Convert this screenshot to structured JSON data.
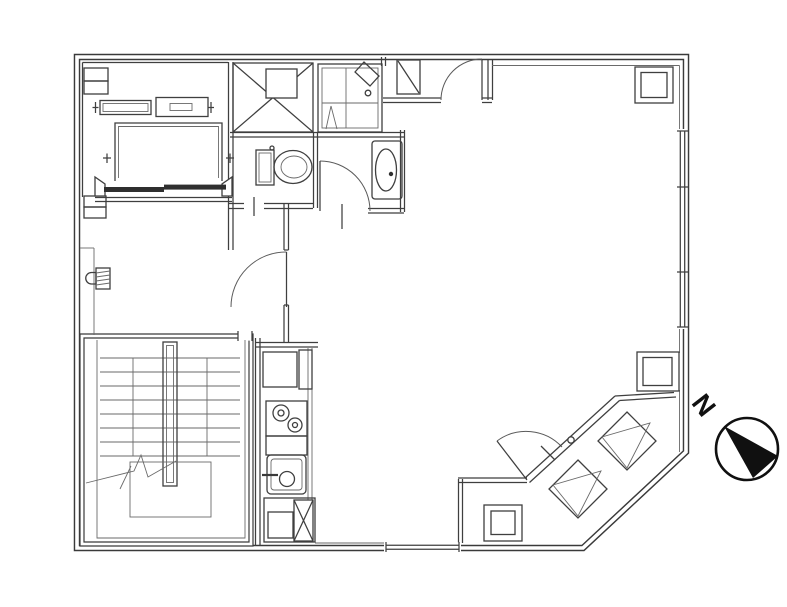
{
  "page": {
    "type": "architectural-floor-plan",
    "background": "#ffffff"
  },
  "colors": {
    "line": "#3a3a3a",
    "thin_line": "#6a6a6a",
    "door_arc": "#5a5a5a",
    "elevator_door": "#2f2f2f",
    "compass": "#101010",
    "background": "#ffffff"
  },
  "compass": {
    "label": "N",
    "direction": "upper-left"
  },
  "rooms": [
    {
      "name": "elevator-shaft"
    },
    {
      "name": "elevator-hall"
    },
    {
      "name": "stairwell"
    },
    {
      "name": "pipe-shaft-x"
    },
    {
      "name": "shower-room"
    },
    {
      "name": "toilet-room"
    },
    {
      "name": "washroom"
    },
    {
      "name": "entry-vestibule"
    },
    {
      "name": "kitchen"
    },
    {
      "name": "main-room"
    },
    {
      "name": "balcony"
    }
  ],
  "fixtures": [
    {
      "name": "elevator-car"
    },
    {
      "name": "elevator-doors"
    },
    {
      "name": "elevator-machine"
    },
    {
      "name": "counterweight-guides"
    },
    {
      "name": "u-shaped-stair-with-break-line"
    },
    {
      "name": "stair-center-rail"
    },
    {
      "name": "toilet"
    },
    {
      "name": "vanity-basin"
    },
    {
      "name": "shower-pan"
    },
    {
      "name": "shower-pivot-door"
    },
    {
      "name": "refrigerator-space"
    },
    {
      "name": "two-burner-stove"
    },
    {
      "name": "kitchen-sink"
    },
    {
      "name": "pipe-shaft-x-kitchen"
    },
    {
      "name": "meter-box"
    },
    {
      "name": "structural-columns",
      "count": 3
    },
    {
      "name": "window-right-wall"
    },
    {
      "name": "window-bottom-wall"
    },
    {
      "name": "balcony-sliding-door"
    },
    {
      "name": "balcony-swing-door"
    },
    {
      "name": "outdoor-ac-units",
      "count": 2
    },
    {
      "name": "north-compass"
    }
  ]
}
